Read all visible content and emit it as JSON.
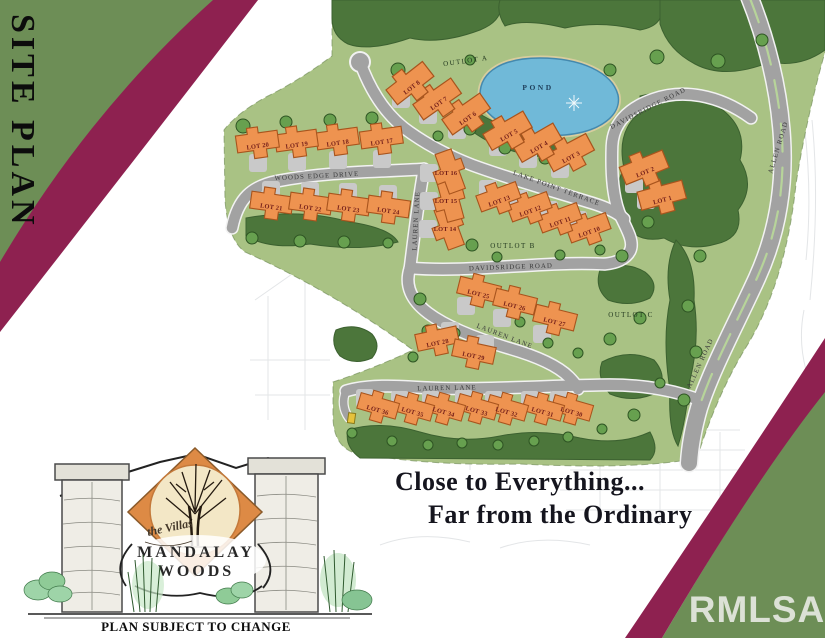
{
  "page": {
    "background": "#ffffff",
    "band_color": "#8e2150",
    "corner_green": "#6d8e56",
    "title_vertical": "SITE PLAN",
    "tagline_line1": "Close to Everything...",
    "tagline_line2": "Far from the Ordinary",
    "watermark": "RMLSA",
    "disclaimer": "PLAN SUBJECT TO CHANGE"
  },
  "logo": {
    "prefix": "the Villas",
    "name_line1": "MANDALAY",
    "name_line2": "WOODS",
    "diamond_color": "#dd8a45",
    "circle_color": "#f3e7c6"
  },
  "map": {
    "colors": {
      "grass": "#a9c284",
      "forest": "#4c763b",
      "tree": "#67a04f",
      "tree_stroke": "#2e5423",
      "road": "#a2a2a2",
      "road_casing": "#f2f2f2",
      "driveway": "#c9c9c9",
      "house": "#ee9350",
      "house_stroke": "#a8541d",
      "pond": "#70b9d8",
      "pond_edge": "#4489ae",
      "sand": "#d8cd9f"
    },
    "pond": {
      "label": "POND",
      "x": 538,
      "y": 90
    },
    "sparkle": {
      "x": 574,
      "y": 103
    },
    "outlots": [
      {
        "label": "OUTLOT A",
        "x": 466,
        "y": 63,
        "rotate": -8
      },
      {
        "label": "OUTLOT B",
        "x": 513,
        "y": 248,
        "rotate": 0
      },
      {
        "label": "OUTLOT C",
        "x": 631,
        "y": 317,
        "rotate": 0
      }
    ],
    "road_labels": [
      {
        "label": "WOODS EDGE DRIVE",
        "x": 317,
        "y": 178,
        "rotate": -3
      },
      {
        "label": "LAUREN LANE",
        "x": 418,
        "y": 221,
        "rotate": -87
      },
      {
        "label": "LAKE POINT TERRACE",
        "x": 556,
        "y": 190,
        "rotate": 20
      },
      {
        "label": "DAVIDSRIDGE ROAD",
        "x": 511,
        "y": 269,
        "rotate": -2
      },
      {
        "label": "DAVIDSRIDGE ROAD",
        "x": 649,
        "y": 110,
        "rotate": -27
      },
      {
        "label": "LAUREN LANE",
        "x": 504,
        "y": 338,
        "rotate": 21
      },
      {
        "label": "LAUREN LANE",
        "x": 447,
        "y": 390,
        "rotate": -1
      },
      {
        "label": "ALLEN ROAD",
        "x": 780,
        "y": 148,
        "rotate": -73
      },
      {
        "label": "ALLEN ROAD",
        "x": 702,
        "y": 364,
        "rotate": -65
      }
    ],
    "lots": [
      {
        "label": "LOT 1",
        "x": 663,
        "y": 200,
        "a": -15,
        "d": "w",
        "s": 1.1
      },
      {
        "label": "LOT 2",
        "x": 646,
        "y": 172,
        "a": -22,
        "d": "sw",
        "s": 1.1
      },
      {
        "label": "LOT 3",
        "x": 572,
        "y": 157,
        "a": -28,
        "d": "sw",
        "s": 1.1
      },
      {
        "label": "LOT 4",
        "x": 540,
        "y": 147,
        "a": -30,
        "d": "sw",
        "s": 1.1
      },
      {
        "label": "LOT 5",
        "x": 510,
        "y": 135,
        "a": -30,
        "d": "sw",
        "s": 1.1
      },
      {
        "label": "LOT 6",
        "x": 469,
        "y": 118,
        "a": -35,
        "d": "sw",
        "s": 1.1
      },
      {
        "label": "LOT 7",
        "x": 440,
        "y": 103,
        "a": -35,
        "d": "sw",
        "s": 1.1
      },
      {
        "label": "LOT 8",
        "x": 413,
        "y": 87,
        "a": -38,
        "d": "sw",
        "s": 1.1
      },
      {
        "label": "LOT 10",
        "x": 590,
        "y": 232,
        "a": -20,
        "d": "nw",
        "s": 1
      },
      {
        "label": "LOT 11",
        "x": 561,
        "y": 222,
        "a": -20,
        "d": "nw",
        "s": 1
      },
      {
        "label": "LOT 12",
        "x": 531,
        "y": 211,
        "a": -20,
        "d": "nw",
        "s": 1
      },
      {
        "label": "LOT 13",
        "x": 500,
        "y": 201,
        "a": -20,
        "d": "nw",
        "s": 1
      },
      {
        "label": "LOT 14",
        "x": 445,
        "y": 229,
        "a": 70,
        "d": "w",
        "s": 1
      },
      {
        "label": "LOT 15",
        "x": 446,
        "y": 201,
        "a": 75,
        "d": "w",
        "s": 1
      },
      {
        "label": "LOT 16",
        "x": 446,
        "y": 173,
        "a": 70,
        "d": "w",
        "s": 1
      },
      {
        "label": "LOT 17",
        "x": 382,
        "y": 142,
        "a": -8,
        "d": "s",
        "s": 1
      },
      {
        "label": "LOT 18",
        "x": 338,
        "y": 143,
        "a": -8,
        "d": "s",
        "s": 1
      },
      {
        "label": "LOT 19",
        "x": 297,
        "y": 145,
        "a": -8,
        "d": "s",
        "s": 1
      },
      {
        "label": "LOT 20",
        "x": 258,
        "y": 146,
        "a": -8,
        "d": "s",
        "s": 1
      },
      {
        "label": "LOT 21",
        "x": 271,
        "y": 207,
        "a": 8,
        "d": "n",
        "s": 1
      },
      {
        "label": "LOT 22",
        "x": 310,
        "y": 208,
        "a": 8,
        "d": "n",
        "s": 1
      },
      {
        "label": "LOT 23",
        "x": 348,
        "y": 209,
        "a": 8,
        "d": "n",
        "s": 1
      },
      {
        "label": "LOT 24",
        "x": 388,
        "y": 211,
        "a": 8,
        "d": "n",
        "s": 1
      },
      {
        "label": "LOT 25",
        "x": 478,
        "y": 294,
        "a": 14,
        "d": "sw",
        "s": 1
      },
      {
        "label": "LOT 26",
        "x": 514,
        "y": 306,
        "a": 14,
        "d": "sw",
        "s": 1
      },
      {
        "label": "LOT 27",
        "x": 554,
        "y": 322,
        "a": 14,
        "d": "sw",
        "s": 1
      },
      {
        "label": "LOT 28",
        "x": 438,
        "y": 343,
        "a": -12,
        "d": "ne",
        "s": 1
      },
      {
        "label": "LOT 29",
        "x": 473,
        "y": 356,
        "a": 12,
        "d": "ne",
        "s": 1
      },
      {
        "label": "LOT 30",
        "x": 571,
        "y": 412,
        "a": 16,
        "d": "nw",
        "s": 0.95
      },
      {
        "label": "LOT 31",
        "x": 542,
        "y": 412,
        "a": 16,
        "d": "nw",
        "s": 0.95
      },
      {
        "label": "LOT 32",
        "x": 506,
        "y": 412,
        "a": 16,
        "d": "nw",
        "s": 0.95
      },
      {
        "label": "LOT 33",
        "x": 476,
        "y": 411,
        "a": 16,
        "d": "nw",
        "s": 0.95
      },
      {
        "label": "LOT 34",
        "x": 443,
        "y": 412,
        "a": 16,
        "d": "nw",
        "s": 0.95
      },
      {
        "label": "LOT 35",
        "x": 412,
        "y": 412,
        "a": 16,
        "d": "nw",
        "s": 0.95
      },
      {
        "label": "LOT 36",
        "x": 377,
        "y": 410,
        "a": 16,
        "d": "nw",
        "s": 0.95
      }
    ],
    "trees": [
      [
        243,
        126,
        7
      ],
      [
        286,
        122,
        6
      ],
      [
        330,
        120,
        6
      ],
      [
        372,
        118,
        6
      ],
      [
        398,
        70,
        7
      ],
      [
        252,
        238,
        6
      ],
      [
        300,
        241,
        6
      ],
      [
        344,
        242,
        6
      ],
      [
        388,
        243,
        5
      ],
      [
        470,
        129,
        6
      ],
      [
        505,
        148,
        6
      ],
      [
        545,
        158,
        6
      ],
      [
        583,
        148,
        5
      ],
      [
        438,
        136,
        5
      ],
      [
        452,
        213,
        6
      ],
      [
        472,
        245,
        6
      ],
      [
        497,
        257,
        5
      ],
      [
        560,
        255,
        5
      ],
      [
        600,
        250,
        5
      ],
      [
        622,
        256,
        6
      ],
      [
        648,
        222,
        6
      ],
      [
        700,
        256,
        6
      ],
      [
        688,
        306,
        6
      ],
      [
        696,
        352,
        6
      ],
      [
        684,
        400,
        6
      ],
      [
        420,
        299,
        6
      ],
      [
        428,
        331,
        6
      ],
      [
        413,
        357,
        5
      ],
      [
        455,
        333,
        5
      ],
      [
        520,
        322,
        5
      ],
      [
        548,
        343,
        5
      ],
      [
        578,
        353,
        5
      ],
      [
        610,
        339,
        6
      ],
      [
        640,
        318,
        6
      ],
      [
        352,
        433,
        5
      ],
      [
        392,
        441,
        5
      ],
      [
        428,
        445,
        5
      ],
      [
        462,
        443,
        5
      ],
      [
        498,
        445,
        5
      ],
      [
        534,
        441,
        5
      ],
      [
        568,
        437,
        5
      ],
      [
        602,
        429,
        5
      ],
      [
        634,
        415,
        6
      ],
      [
        660,
        383,
        5
      ],
      [
        610,
        70,
        6
      ],
      [
        657,
        57,
        7
      ],
      [
        718,
        61,
        7
      ],
      [
        762,
        40,
        6
      ],
      [
        470,
        60,
        5
      ]
    ]
  }
}
